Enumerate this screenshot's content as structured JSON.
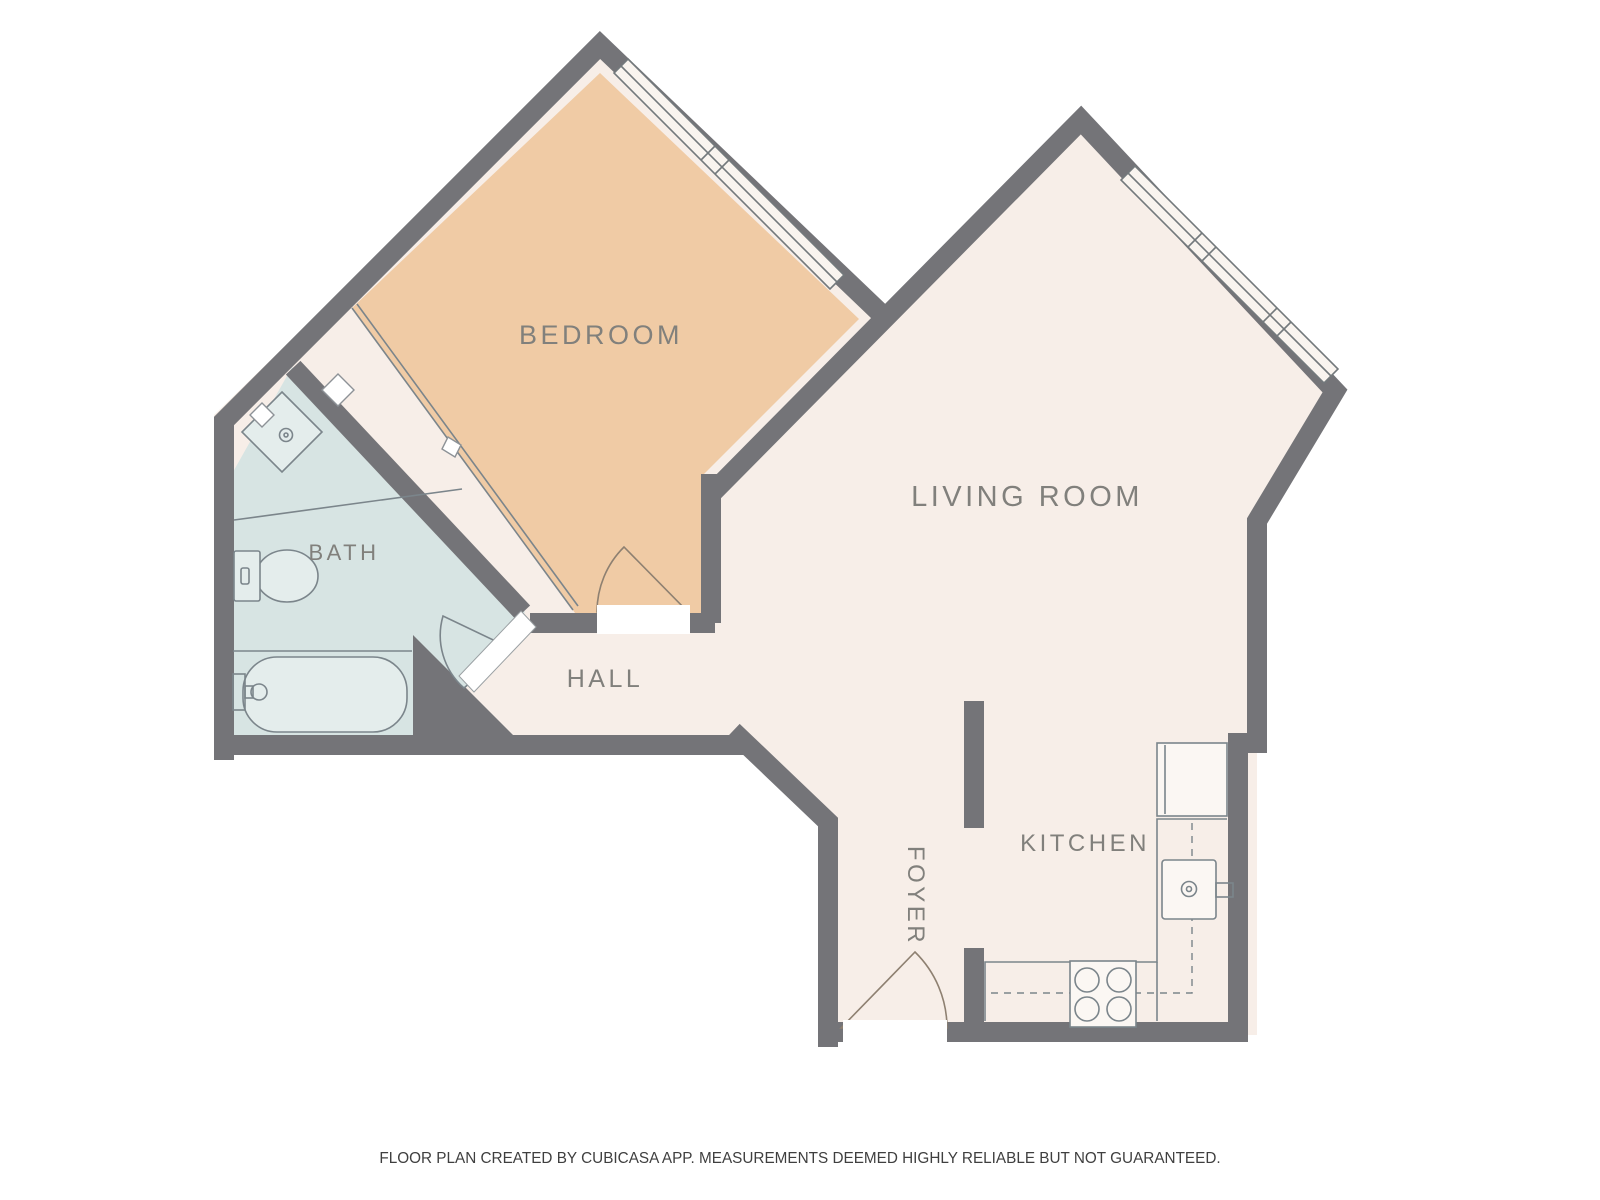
{
  "floorplan": {
    "title": "Apartment floor plan",
    "rooms": [
      {
        "id": "bedroom",
        "label": "BEDROOM"
      },
      {
        "id": "living-room",
        "label": "LIVING ROOM"
      },
      {
        "id": "bath",
        "label": "BATH"
      },
      {
        "id": "hall",
        "label": "HALL"
      },
      {
        "id": "foyer",
        "label": "FOYER"
      },
      {
        "id": "kitchen",
        "label": "KITCHEN"
      }
    ],
    "fixtures": [
      {
        "id": "bath-sink",
        "name": "bathroom sink vanity"
      },
      {
        "id": "toilet",
        "name": "toilet"
      },
      {
        "id": "bathtub",
        "name": "bathtub"
      },
      {
        "id": "sliding-closet",
        "name": "sliding door closet"
      },
      {
        "id": "refrigerator",
        "name": "refrigerator"
      },
      {
        "id": "kitchen-sink",
        "name": "kitchen sink"
      },
      {
        "id": "stove",
        "name": "four burner stove"
      },
      {
        "id": "counter",
        "name": "kitchen counter"
      }
    ],
    "doors": [
      {
        "id": "bedroom-door",
        "name": "bedroom swing door"
      },
      {
        "id": "bath-door",
        "name": "bathroom swing door"
      },
      {
        "id": "entry-door",
        "name": "foyer entry swing door"
      }
    ],
    "windows": [
      {
        "id": "bedroom-window",
        "name": "bedroom window"
      },
      {
        "id": "living-room-window",
        "name": "living room window"
      }
    ],
    "colors": {
      "wall": "#747478",
      "bedroom": "#f0cba5",
      "bath": "#d7e4e3",
      "cream": "#f7eee8",
      "fixture_line": "#7b858b",
      "door_line": "#8e8071",
      "label": "#81807c",
      "footer": "#3f3f3f"
    },
    "footer": {
      "disclaimer": "FLOOR PLAN CREATED BY CUBICASA APP. MEASUREMENTS DEEMED HIGHLY RELIABLE BUT NOT GUARANTEED."
    }
  }
}
